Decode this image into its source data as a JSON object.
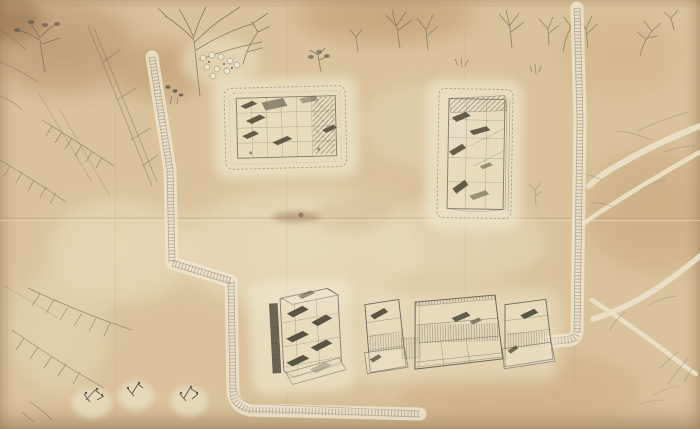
{
  "artwork": {
    "medium": "pencil and wash drawing on aged, folded paper",
    "scene": "bird's-eye site plan: three walled compounds, a row of three outbuildings, dotted footpaths with right-angle elbows, and sketched trees along the top and left edges",
    "palette": {
      "paper_base": "#d9c29c",
      "paper_light": "#ece1c4",
      "paper_cream": "#f2ead4",
      "wash_tan": "#c6a87e",
      "wash_brown": "#ab845a",
      "stain_dark": "#7d5f41",
      "pencil": "#6e6a5b",
      "pencil_dark": "#403d33",
      "halo": "#efe7cf",
      "path_rung": "#8c8673"
    },
    "features": {
      "north_compound": {
        "label": "walled compound with dark roofed halls, upper centre"
      },
      "east_compound": {
        "label": "tall walled compound with dark roofed halls, upper right"
      },
      "south_building": {
        "label": "tall multi-roofed building, lower centre"
      },
      "outbuildings": {
        "label": "row of three hatched outbuildings, lower right",
        "count": 3
      },
      "west_path": {
        "label": "dotted ladder footpath descending from top left with two elbows, running east along the bottom"
      },
      "east_path": {
        "label": "dotted ladder footpath descending on the right, turning west to the outbuildings"
      },
      "vegetation": {
        "label": "pencil trees, white blossom cluster, pine boughs on the left, pale branches on the right"
      },
      "fold": {
        "label": "horizontal fold crease with brown smudge at centre of sheet"
      },
      "mounds": {
        "label": "three pale mounds with small dark plants along lower left"
      }
    }
  }
}
